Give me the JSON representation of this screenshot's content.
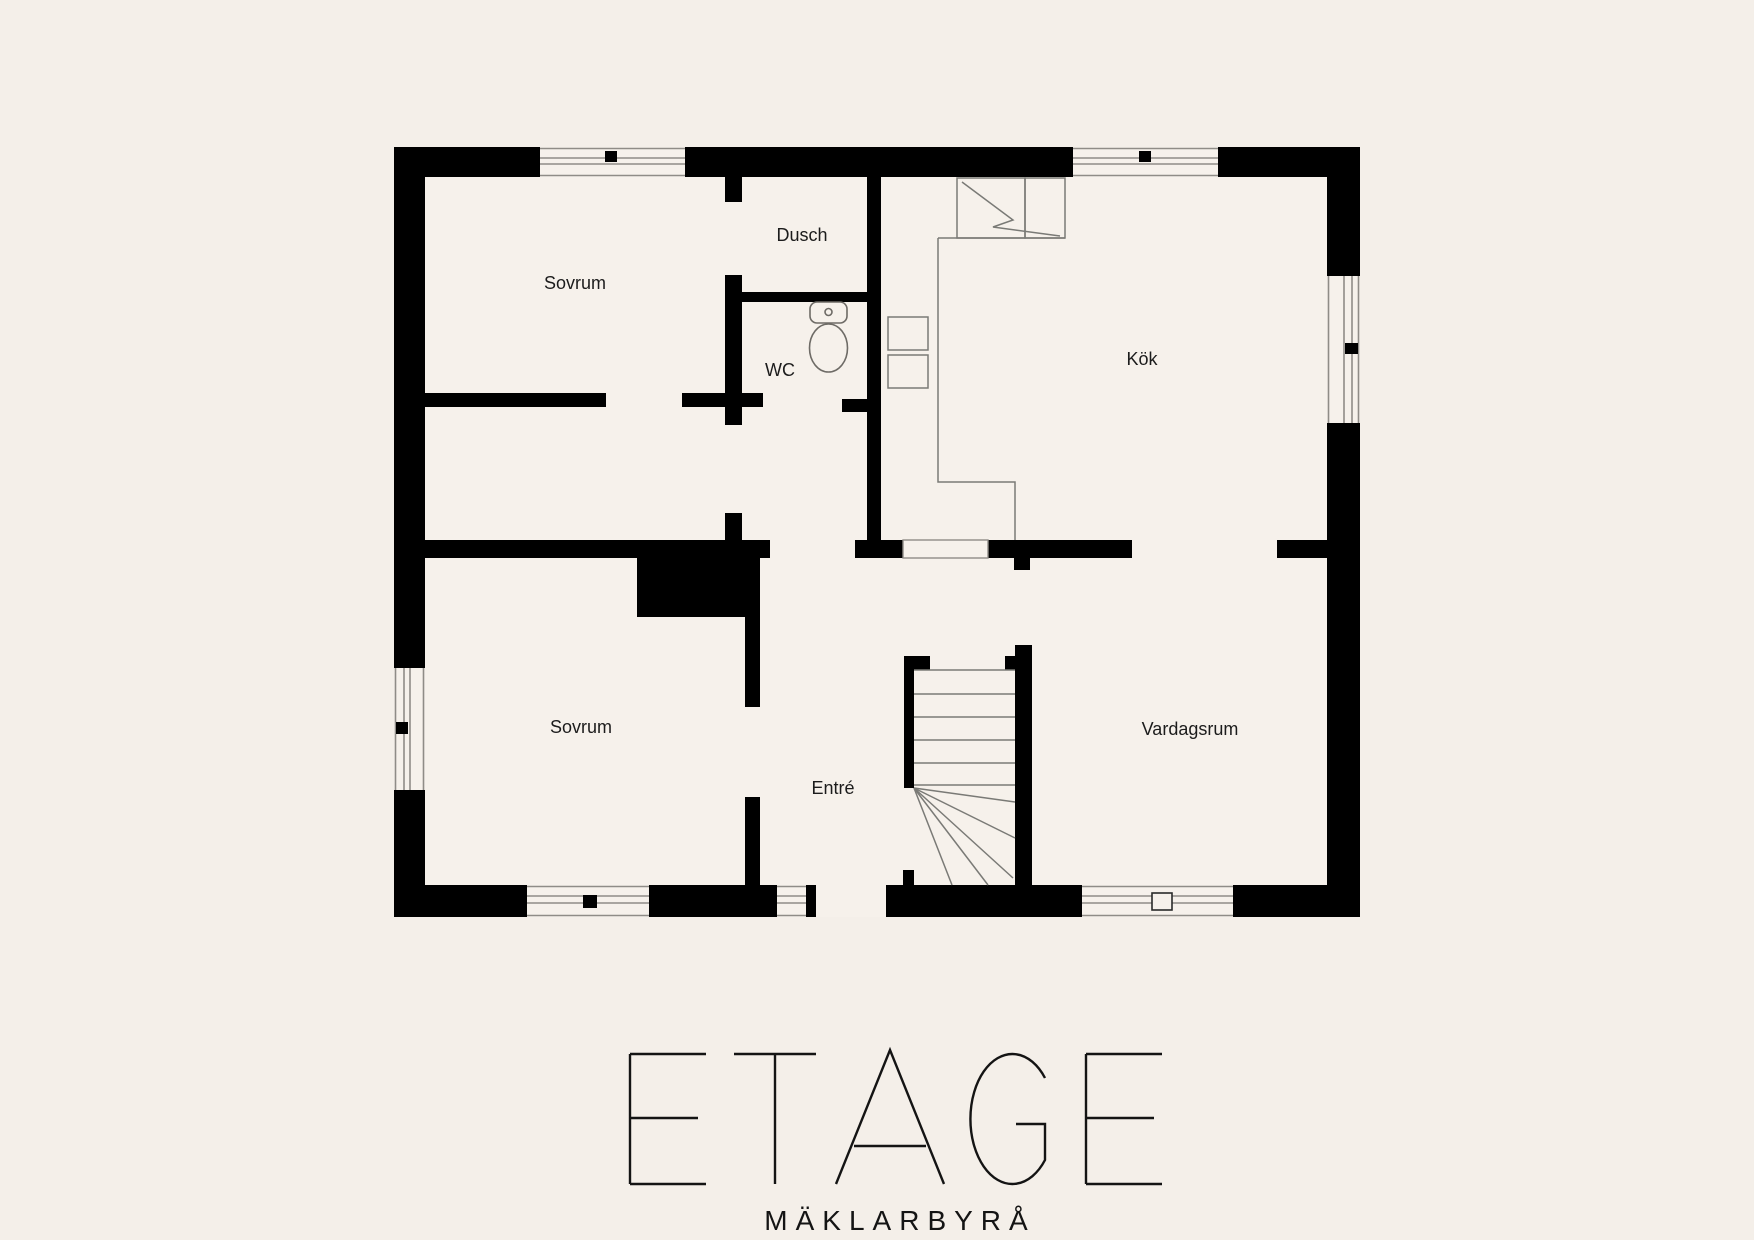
{
  "colors": {
    "background": "#f4efe9",
    "floor": "#f6f1eb",
    "wall": "#000000"
  },
  "rooms": [
    {
      "id": "sovrum-1",
      "label": "Sovrum"
    },
    {
      "id": "dusch",
      "label": "Dusch"
    },
    {
      "id": "wc",
      "label": "WC"
    },
    {
      "id": "kok",
      "label": "Kök"
    },
    {
      "id": "sovrum-2",
      "label": "Sovrum"
    },
    {
      "id": "entre",
      "label": "Entré"
    },
    {
      "id": "vardagsrum",
      "label": "Vardagsrum"
    }
  ],
  "fixtures": [
    "stairs-winder",
    "toilet",
    "refrigerator-freezer",
    "kitchen-counter",
    "appliance-squares",
    "wardrobe-block"
  ],
  "openings": {
    "windows": 6,
    "entrance_door": 1
  },
  "brand": {
    "name": "ETAGE",
    "tagline": "MÄKLARBYRÅ"
  }
}
